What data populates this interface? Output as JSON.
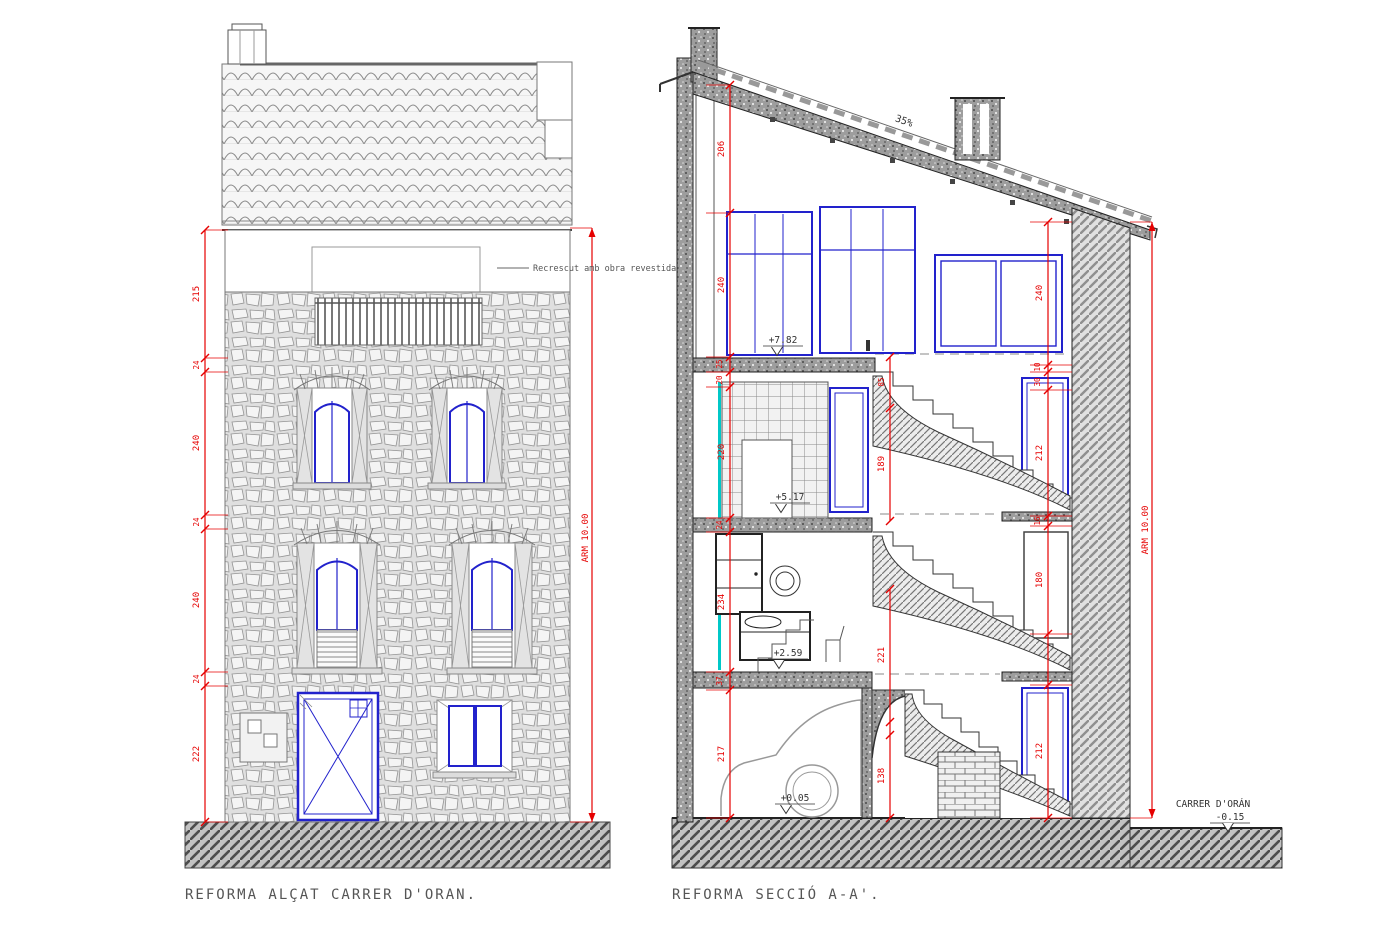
{
  "captions": {
    "elevation": "REFORMA ALÇAT CARRER D'ORAN.",
    "section": "REFORMA SECCIÓ A-A'."
  },
  "notes": {
    "facade_note": "Recrescut amb obra revestida"
  },
  "labels": {
    "roof_slope": "35%",
    "arm_elevation": "ARM 10.00",
    "arm_section": "ARM 10.00",
    "street_name": "CARRER D'ORÁN",
    "street_level": "-0.15"
  },
  "elevation": {
    "dim_chain": [
      "215",
      "24",
      "240",
      "24",
      "240",
      "24",
      "222"
    ]
  },
  "section": {
    "dims_left": [
      "206",
      "240",
      "25",
      "20",
      "220",
      "24",
      "234",
      "37",
      "217"
    ],
    "dims_mid": [
      "85",
      "189",
      "221",
      "138"
    ],
    "dims_right": [
      "240",
      "10",
      "30",
      "212",
      "16",
      "180",
      "212"
    ],
    "levels": [
      "+7.82",
      "+5.17",
      "+2.59",
      "+0.05"
    ]
  },
  "colors": {
    "dimension_red": "#e60000",
    "window_blue": "#2222cc",
    "insulation_cyan": "#00c8c8"
  }
}
